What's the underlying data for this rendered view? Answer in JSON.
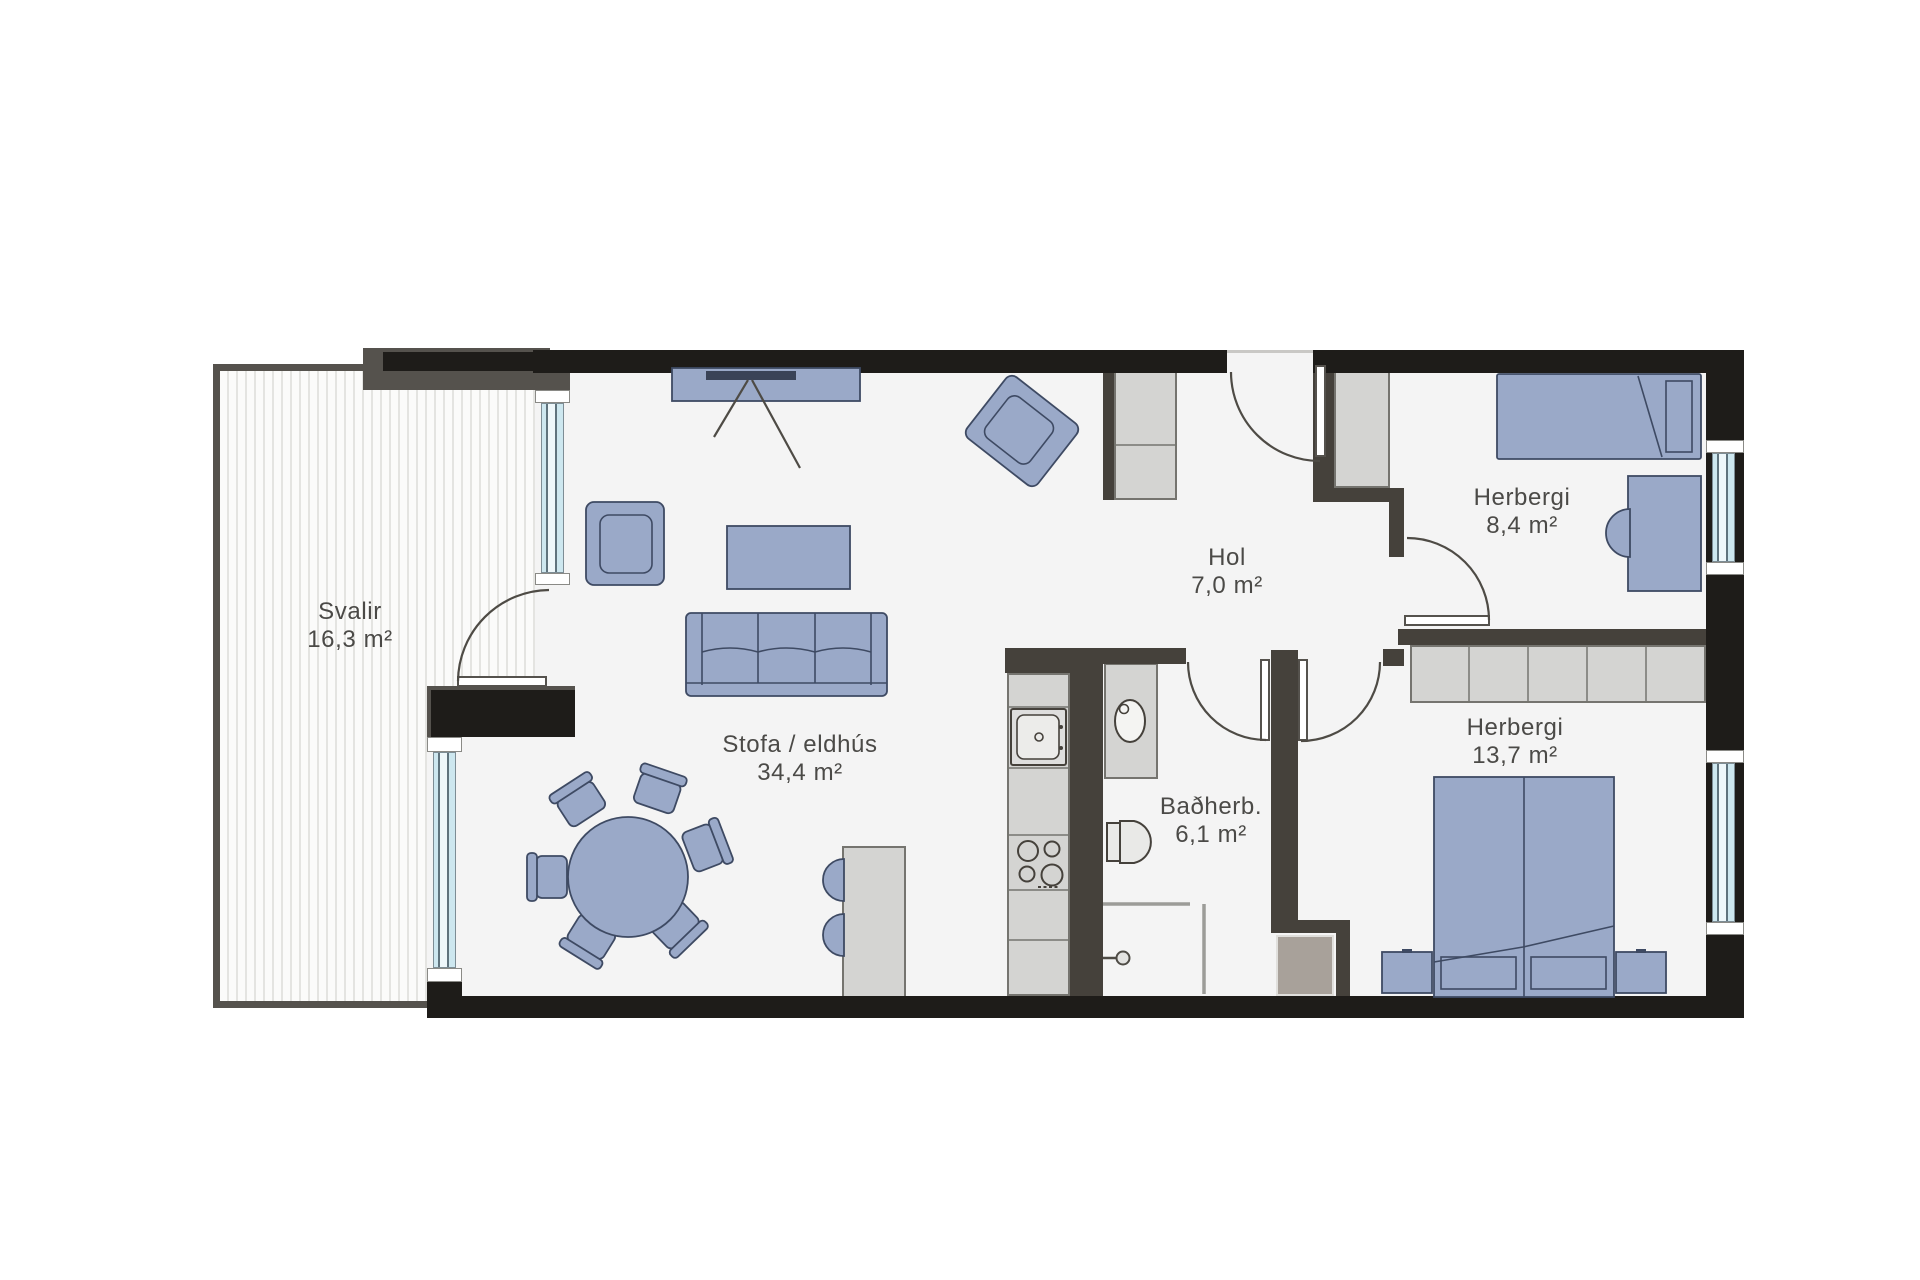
{
  "floorplan": {
    "type": "apartment-floor-plan",
    "rooms": [
      {
        "id": "svalir",
        "name": "Svalir",
        "area": "16,3 m²"
      },
      {
        "id": "stofa-eldhus",
        "name": "Stofa / eldhús",
        "area": "34,4 m²"
      },
      {
        "id": "hol",
        "name": "Hol",
        "area": "7,0 m²"
      },
      {
        "id": "badherbergi",
        "name": "Baðherb.",
        "area": "6,1 m²"
      },
      {
        "id": "herbergi-small",
        "name": "Herbergi",
        "area": "8,4 m²"
      },
      {
        "id": "herbergi-large",
        "name": "Herbergi",
        "area": "13,7 m²"
      }
    ],
    "furniture_icons": [
      "tv-bench-icon",
      "armchair-icon",
      "coffee-table-icon",
      "sofa-icon",
      "dining-table-icon",
      "dining-chair-icon",
      "kitchen-counter-icon",
      "kitchen-sink-icon",
      "cooktop-icon",
      "small-table-icon",
      "wash-basin-icon",
      "toilet-icon",
      "shower-icon",
      "wardrobe-icon",
      "closet-icon",
      "single-bed-icon",
      "desk-icon",
      "desk-chair-icon",
      "double-bed-icon",
      "nightstand-icon",
      "door-swing-icon",
      "window-icon"
    ],
    "colors": {
      "exterior_wall": "#1e1c19",
      "partition_wall": "#45413b",
      "balcony_outline": "#55524d",
      "floor": "#f4f4f4",
      "deck_stripe": "#e4e4e1",
      "furniture_blue": "#9aa9c8",
      "furniture_blue_border": "#3e4a63",
      "furniture_gray": "#d4d4d2",
      "utility_taupe": "#a8a19a",
      "window_glass": "#cde7ef",
      "text": "#4b4a47"
    }
  }
}
